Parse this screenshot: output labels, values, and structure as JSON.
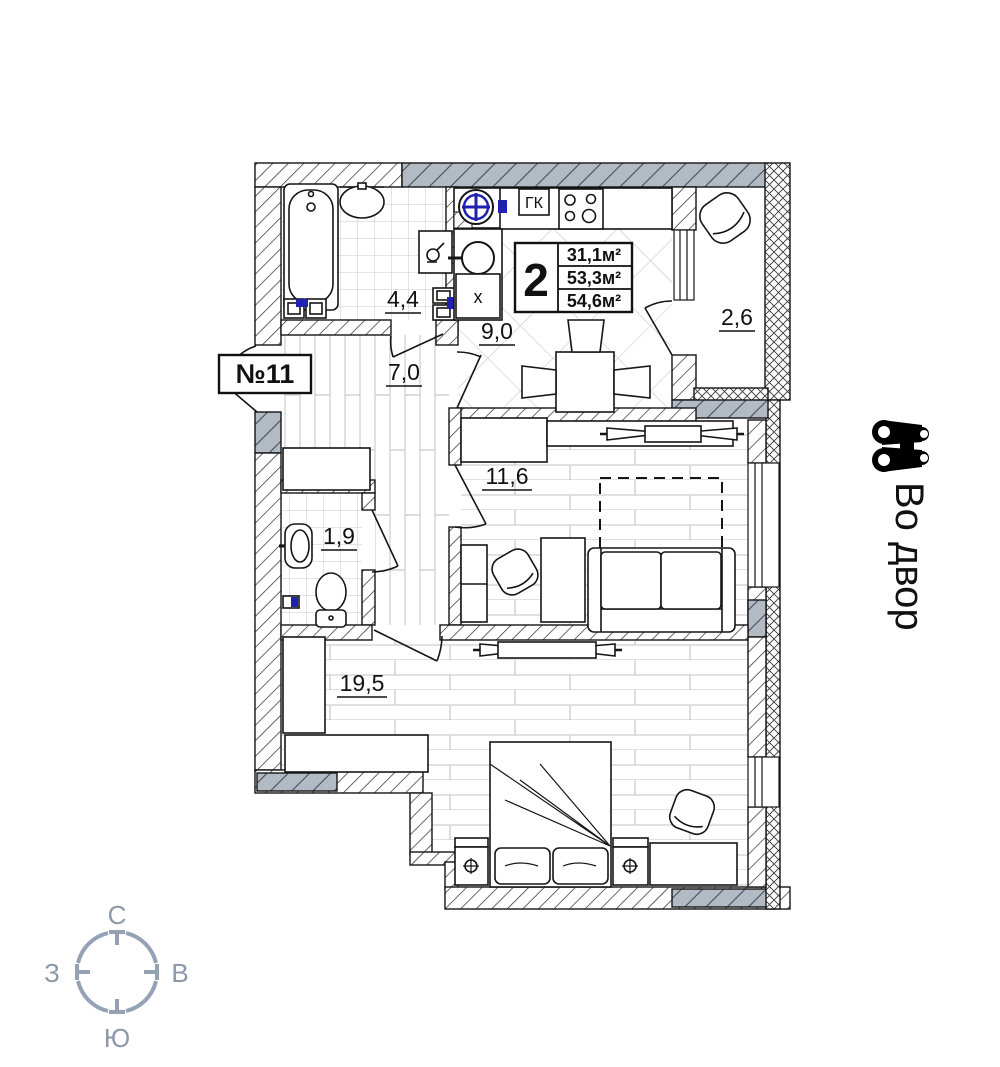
{
  "labels": {
    "apartment_number": "№11",
    "gas_boiler": "ГК",
    "washer_box": "х",
    "view_note": "Во двор"
  },
  "info_box": {
    "rooms_count": "2",
    "living_area": "31,1м²",
    "apartment_area": "53,3м²",
    "total_area": "54,6м²"
  },
  "rooms": {
    "bathroom": {
      "area": "4,4"
    },
    "kitchen": {
      "area": "9,0"
    },
    "balcony": {
      "area": "2,6"
    },
    "hallway": {
      "area": "7,0"
    },
    "wc": {
      "area": "1,9"
    },
    "living": {
      "area": "11,6"
    },
    "bedroom": {
      "area": "19,5"
    }
  },
  "compass": {
    "north": "С",
    "east": "В",
    "south": "Ю",
    "west": "З"
  },
  "icons": {
    "view": "binoculars-icon",
    "vent": "fan-icon",
    "compass": "compass-rose"
  },
  "colors": {
    "wall_grey": "#b2bac4",
    "accent_blue": "#2121b0",
    "compass_grey": "#95a2b4",
    "line_black": "#151515"
  }
}
